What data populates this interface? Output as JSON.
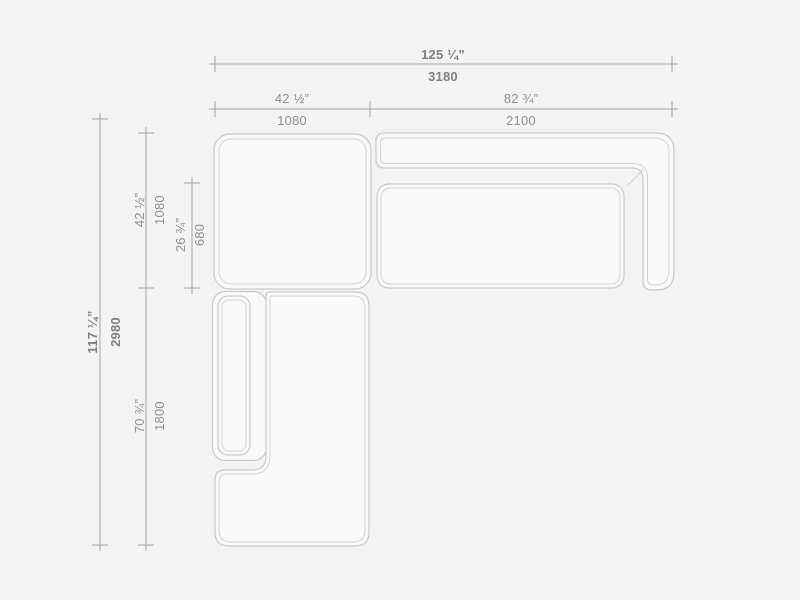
{
  "drawing": {
    "type": "sectional-sofa-top-view-technical-drawing",
    "colors": {
      "background": "#f4f4f4",
      "module_fill": "#fafafa",
      "module_outline": "#c9c9c9",
      "dimension_line": "#a2a2a2",
      "dimension_text": "#8f8f8f",
      "dimension_text_bold": "#7f7f7f"
    }
  },
  "dimensions": {
    "overall_width": {
      "inches": "125 ¼”",
      "mm": "3180"
    },
    "corner_module_width": {
      "inches": "42 ½”",
      "mm": "1080"
    },
    "right_module_width": {
      "inches": "82 ¾”",
      "mm": "2100"
    },
    "overall_depth": {
      "inches": "117 ¼”",
      "mm": "2980"
    },
    "corner_module_depth": {
      "inches": "42 ½”",
      "mm": "1080"
    },
    "seat_depth": {
      "inches": "26 ¾”",
      "mm": "680"
    },
    "chaise_depth": {
      "inches": "70 ¾”",
      "mm": "1800"
    }
  }
}
